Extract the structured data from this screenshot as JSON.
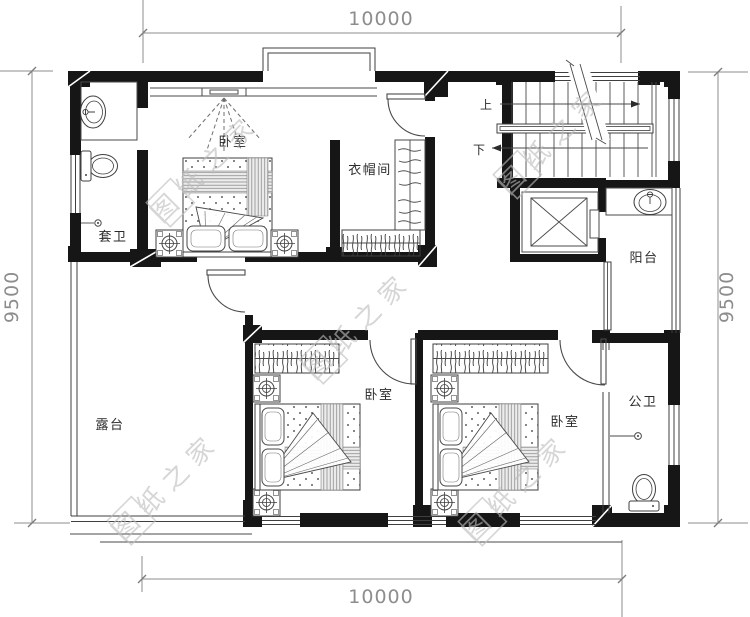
{
  "drawing": {
    "type": "floor-plan",
    "watermark": {
      "text": "图纸之家",
      "color": "#bdbdbd"
    },
    "dimensions": {
      "top": "10000",
      "bottom": "10000",
      "left": "9500",
      "right": "9500"
    },
    "rooms": {
      "master_bedroom": "卧室",
      "cloakroom": "衣帽间",
      "ensuite_bath": "套卫",
      "bedroom_left": "卧室",
      "bedroom_right": "卧室",
      "terrace": "露台",
      "balcony": "阳台",
      "public_bath": "公卫"
    },
    "stairs": {
      "up": "上",
      "down": "下"
    },
    "colors": {
      "wall": "#161616",
      "line": "#3f3f3f",
      "dim_text": "#8d8d8d",
      "label_text": "#2b2b2b"
    }
  }
}
